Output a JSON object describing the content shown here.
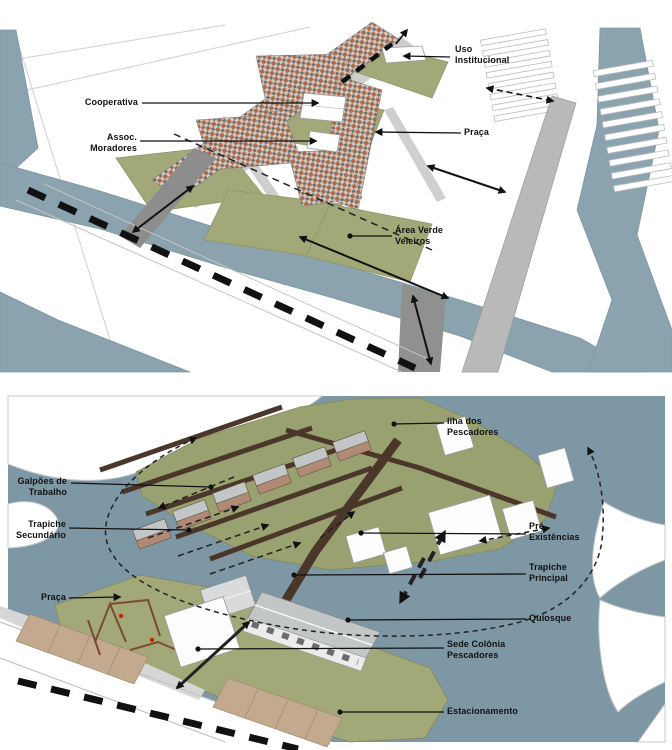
{
  "top_panel": {
    "labels": {
      "uso_institucional": {
        "lines": [
          "Uso",
          "Institucional"
        ]
      },
      "cooperativa": {
        "lines": [
          "Cooperativa"
        ]
      },
      "assoc_moradores": {
        "lines": [
          "Assoc.",
          "Moradores"
        ]
      },
      "praca": {
        "lines": [
          "Praça"
        ]
      },
      "area_verde": {
        "lines": [
          "Área Verde",
          "Veleiros"
        ]
      }
    }
  },
  "bottom_panel": {
    "labels": {
      "ilha_dos_pescadores": {
        "lines": [
          "Ilha dos",
          "Pescadores"
        ]
      },
      "galpoes_de_trabalho": {
        "lines": [
          "Galpões de",
          "Trabalho"
        ]
      },
      "trapiche_secundario": {
        "lines": [
          "Trapiche",
          "Secundário"
        ]
      },
      "praca": {
        "lines": [
          "Praça"
        ]
      },
      "pre_existencias": {
        "lines": [
          "Pré",
          "Existências"
        ]
      },
      "trapiche_principal": {
        "lines": [
          "Trapiche",
          "Principal"
        ]
      },
      "quiosque": {
        "lines": [
          "Quiosque"
        ]
      },
      "sede_colonia": {
        "lines": [
          "Sede Colônia",
          "Pescadores"
        ]
      },
      "estacionamento": {
        "lines": [
          "Estacionamento"
        ]
      }
    }
  },
  "colors": {
    "water_top": "#8BA3AF",
    "water_bottom": "#7E97A4",
    "green": "#A3A878",
    "island_green": "#9AA171",
    "pier_brown": "#4A372A",
    "roof_gray": "#C3C6C7",
    "house_orange": "#B2694B",
    "parking_tan": "#C3A98D",
    "street_gray": "#CFCFCF",
    "promenade_gray": "#B9B9B9",
    "arrow_black": "#111111",
    "label_text": "#111111"
  }
}
